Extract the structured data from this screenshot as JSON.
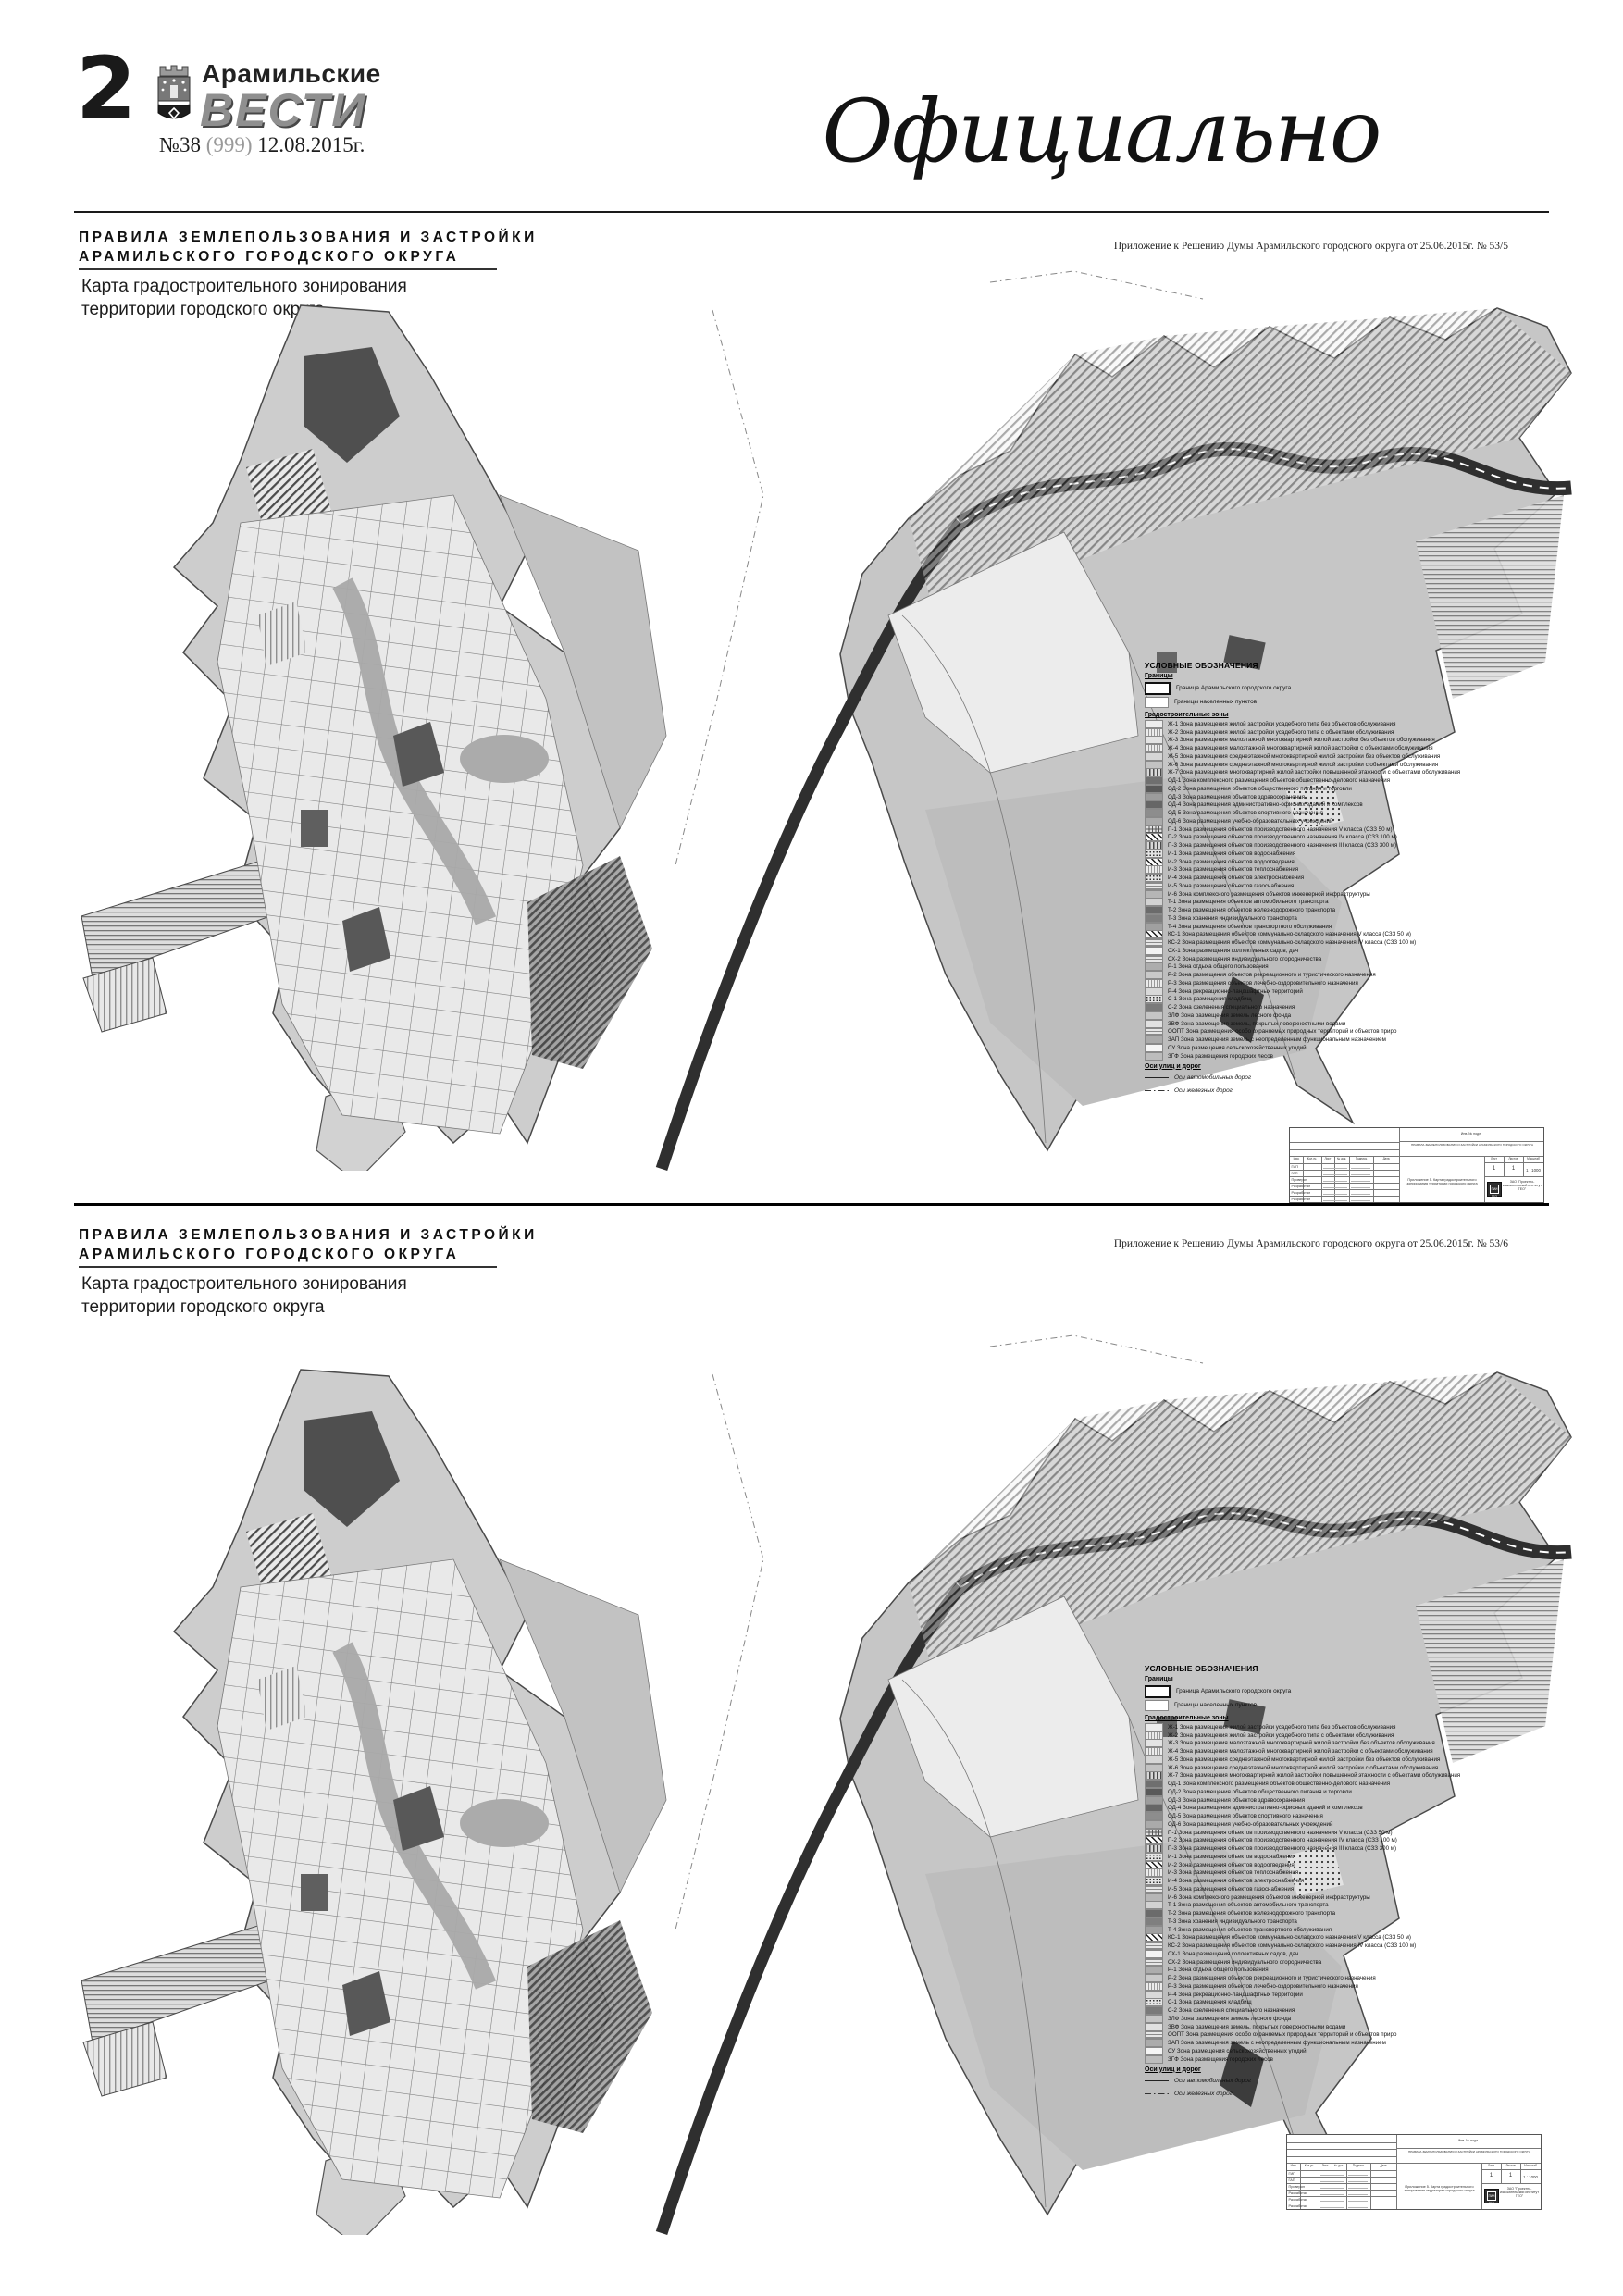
{
  "header": {
    "page_number": "2",
    "newspaper_top": "Арамильские",
    "newspaper_name": "ВЕСТИ",
    "issue_no": "№38",
    "issue_paren": "(999)",
    "issue_date": "12.08.2015г.",
    "section_label": "Официально"
  },
  "sections": [
    {
      "title1": "ПРАВИЛА ЗЕМЛЕПОЛЬЗОВАНИЯ И ЗАСТРОЙКИ",
      "title2": "АРАМИЛЬСКОГО ГОРОДСКОГО ОКРУГА",
      "subtitle1": "Карта градостроительного зонирования",
      "subtitle2": "территории городского округа",
      "annotation": "Приложение к Решению Думы Арамильского городского округа от 25.06.2015г. № 53/5"
    },
    {
      "title1": "ПРАВИЛА ЗЕМЛЕПОЛЬЗОВАНИЯ И ЗАСТРОЙКИ",
      "title2": "АРАМИЛЬСКОГО ГОРОДСКОГО ОКРУГА",
      "subtitle1": "Карта градостроительного зонирования",
      "subtitle2": "территории городского округа",
      "annotation": "Приложение к Решению Думы Арамильского городского округа от 25.06.2015г. № 53/6"
    }
  ],
  "legend": {
    "title": "УСЛОВНЫЕ ОБОЗНАЧЕНИЯ",
    "boundaries_group": "Границы",
    "boundaries": [
      {
        "label": "Граница Арамильского городского округа",
        "swatch": "thick"
      },
      {
        "label": "Границы населенных пунктов",
        "swatch": "thin"
      }
    ],
    "zones_group": "Градостроительные зоны",
    "zones": [
      {
        "code": "Ж-1",
        "label": "Зона размещения жилой застройки усадебного типа без объектов обслуживания",
        "swatch": "solid",
        "color": "#ededed"
      },
      {
        "code": "Ж-2",
        "label": "Зона размещения жилой застройки усадебного типа с объектами обслуживания",
        "swatch": "vlines",
        "color": "#ececec"
      },
      {
        "code": "Ж-3",
        "label": "Зона размещения малоэтажной многоквартирной жилой  застройки без объектов обслуживания",
        "swatch": "solid",
        "color": "#e4e4e4"
      },
      {
        "code": "Ж-4",
        "label": "Зона размещения малоэтажной многоквартирной жилой  застройки  с объектами обслуживания",
        "swatch": "vlines",
        "color": "#e0e0e0"
      },
      {
        "code": "Ж-5",
        "label": "Зона размещения среднеэтажной многоквартирной жилой застройки  без объектов обслуживания",
        "swatch": "solid",
        "color": "#d6d6d6"
      },
      {
        "code": "Ж-6",
        "label": "Зона размещения среднеэтажной многоквартирной жилой застройки с объектами обслуживания",
        "swatch": "solid",
        "color": "#c2c2c2"
      },
      {
        "code": "Ж-7",
        "label": "Зона размещения многоквартирной жилой застройки повышенной этажности с объектами обслуживания",
        "swatch": "vlines-dark",
        "color": "#c8c8c8"
      },
      {
        "code": "ОД-1",
        "label": "Зона комплексного размещения объектов  общественно-делового назначения",
        "swatch": "solid",
        "color": "#6f6f6f"
      },
      {
        "code": "ОД-2",
        "label": "Зона размещения объектов общественного питания и торговли",
        "swatch": "solid",
        "color": "#595959"
      },
      {
        "code": "ОД-3",
        "label": "Зона размещения объектов здравоохранения",
        "swatch": "solid",
        "color": "#9c9c9c"
      },
      {
        "code": "ОД-4",
        "label": "Зона размещения административно-офисных зданий и комплексов",
        "swatch": "solid",
        "color": "#666666"
      },
      {
        "code": "ОД-5",
        "label": "Зона размещения объектов спортивного назначения",
        "swatch": "solid",
        "color": "#8d8d8d"
      },
      {
        "code": "ОД-6",
        "label": "Зона размещения учебно-образовательных учреждений",
        "swatch": "solid",
        "color": "#aaaaaa"
      },
      {
        "code": "П-1",
        "label": "Зона размещения объектов производственного назначения V класса (СЗЗ 50 м)",
        "swatch": "grid",
        "color": "#e2e2e2"
      },
      {
        "code": "П-2",
        "label": "Зона размещения объектов  производственного назначения IV класса (СЗЗ 100 м)",
        "swatch": "diag",
        "color": "#fafafa"
      },
      {
        "code": "П-3",
        "label": "Зона размещения объектов  производственного назначения III класса (СЗЗ 300 м)",
        "swatch": "vlines-dark",
        "color": "#d8d8d8"
      },
      {
        "code": "И-1",
        "label": "Зона размещения объектов водоснабжения",
        "swatch": "dots",
        "color": "#e4e4e4"
      },
      {
        "code": "И-2",
        "label": "Зона размещения объектов водоотведения",
        "swatch": "diag",
        "color": "#fafafa"
      },
      {
        "code": "И-3",
        "label": "Зона размещения объектов теплоснабжения",
        "swatch": "vlines",
        "color": "#ececec"
      },
      {
        "code": "И-4",
        "label": "Зона размещения объектов электроснабжения",
        "swatch": "dots",
        "color": "#e4e4e4"
      },
      {
        "code": "И-5",
        "label": "Зона размещения объектов газоснабжения",
        "swatch": "hlines",
        "color": "#e6e6e6"
      },
      {
        "code": "И-6",
        "label": "Зона комплексного размещения объектов инженерной инфраструктуры",
        "swatch": "solid",
        "color": "#b6b6b6"
      },
      {
        "code": "Т-1",
        "label": "Зона размещения объектов автомобильного транспорта",
        "swatch": "solid",
        "color": "#d2d2d2"
      },
      {
        "code": "Т-2",
        "label": "Зона размещения объектов железнодорожного транспорта",
        "swatch": "solid",
        "color": "#6b6b6b"
      },
      {
        "code": "Т-3",
        "label": "Зона хранения индивидуального транспорта",
        "swatch": "solid",
        "color": "#7f7f7f"
      },
      {
        "code": "Т-4",
        "label": "Зона размещения объектов транспортного обслуживания",
        "swatch": "solid",
        "color": "#a0a0a0"
      },
      {
        "code": "КС-1",
        "label": "Зона размещения объектов коммунально-складского назначения V класса (СЗЗ 50 м)",
        "swatch": "diag",
        "color": "#fafafa"
      },
      {
        "code": "КС-2",
        "label": "Зона размещения объектов коммунально-складского назначения IV класса (СЗЗ 100 м)",
        "swatch": "hlines",
        "color": "#cfcfcf"
      },
      {
        "code": "СХ-1",
        "label": "Зона размещения коллективных садов, дач",
        "swatch": "solid",
        "color": "#f3f3f3"
      },
      {
        "code": "СХ-2",
        "label": "Зона размещения индивидуального огородничества",
        "swatch": "hlines",
        "color": "#eeeeee"
      },
      {
        "code": "Р-1",
        "label": "Зона отдыха общего пользования",
        "swatch": "solid",
        "color": "#adadad"
      },
      {
        "code": "Р-2",
        "label": "Зона размещения объектов рекреационного и туристического назначения",
        "swatch": "solid",
        "color": "#c9c9c9"
      },
      {
        "code": "Р-3",
        "label": "Зона размещения объектов лечебно-оздоровительного назначения",
        "swatch": "vlines",
        "color": "#f2f2f2"
      },
      {
        "code": "Р-4",
        "label": "Зона рекреационно-ландшафтных территорий",
        "swatch": "solid",
        "color": "#d9d9d9"
      },
      {
        "code": "С-1",
        "label": "Зона размещения кладбищ",
        "swatch": "dots",
        "color": "#e8e8e8"
      },
      {
        "code": "С-2",
        "label": "Зона озеленения специального назначения",
        "swatch": "solid",
        "color": "#7a7a7a"
      },
      {
        "code": "ЗЛФ",
        "label": "Зона размещения земель лесного фонда",
        "swatch": "solid",
        "color": "#c5c5c5"
      },
      {
        "code": "ЗВФ",
        "label": "Зона размещения земель, покрытых поверхностными  водами",
        "swatch": "solid",
        "color": "#e1e1e1"
      },
      {
        "code": "ООПТ",
        "label": "Зона размещения особо охраняемых природных территорий и объектов приро",
        "swatch": "hlines",
        "color": "#dddddd"
      },
      {
        "code": "ЗАП",
        "label": "Зона размещения земель с неопределенным функциональным назначением",
        "swatch": "solid",
        "color": "#ababab"
      },
      {
        "code": "СУ",
        "label": "Зона размещения сельскохозяйственных угодий",
        "swatch": "solid",
        "color": "#f5f5f5"
      },
      {
        "code": "ЗГФ",
        "label": "Зона размещения городских лесов",
        "swatch": "solid",
        "color": "#bcbcbc"
      }
    ],
    "axes_group": "Оси улиц и дорог",
    "axes": [
      {
        "label": "Оси автомобильных дорог",
        "line": "solid"
      },
      {
        "label": "Оси железных дорог",
        "line": "dashdot"
      }
    ]
  },
  "stamp": {
    "inv": "Инв. № подл.",
    "doc_title": "ПРАВИЛА ЗЕМЛЕПОЛЬЗОВАНИЯ И ЗАСТРОЙКИ АРАМИЛЬСКОГО ГОРОДСКОГО ОКРУГА",
    "cols": [
      "Изм.",
      "Кол.уч.",
      "Лист",
      "№ док.",
      "Подпись",
      "Дата"
    ],
    "roles": [
      "ГИП",
      "ГАП",
      "Проверил",
      "Разработал",
      "Разработал",
      "Разработал"
    ],
    "sheet_label": "Лист",
    "sheets_label": "Листов",
    "scale_label": "Масштаб",
    "sheet": "1",
    "sheets": "1",
    "scale": "1 : 1000",
    "caption": "Приложение 5. Карта градостроительного зонирования территории городского округа",
    "org": "ЗАО \"Проектно-изыскательский институт ГЕО\"",
    "logo_text": "ПИИ ГЕО"
  },
  "colors": {
    "map_base": "#cdcdcd",
    "map_dark": "#4f4f4f",
    "road": "#2f2f2f",
    "vesti_gray": "#8f8f8f"
  }
}
